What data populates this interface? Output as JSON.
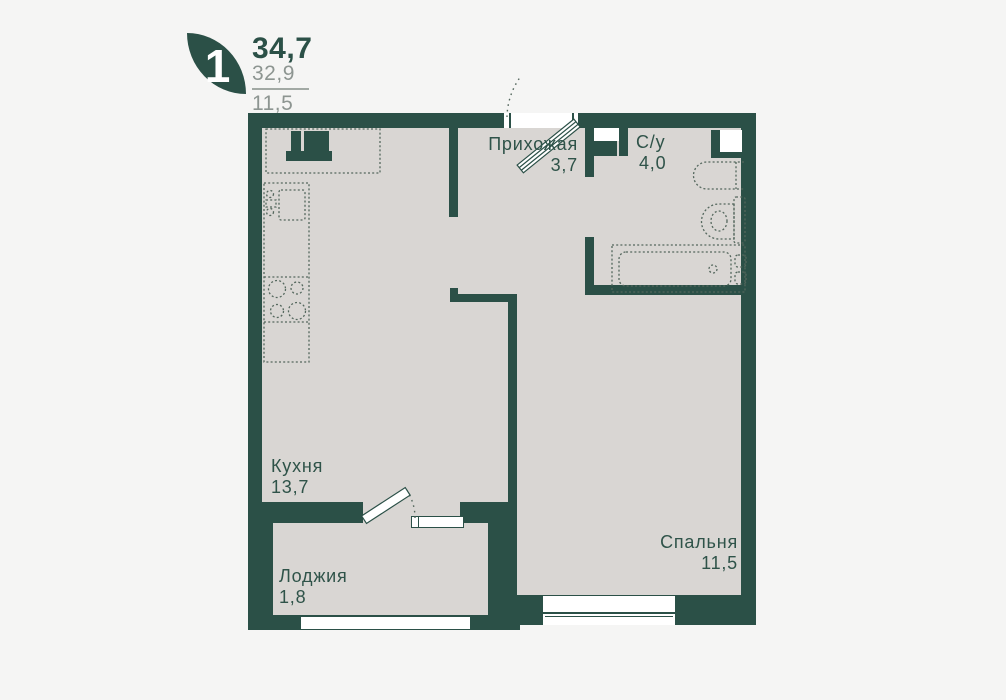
{
  "legend": {
    "rooms_count": "1",
    "total_area": "34,7",
    "living_area": "32,9",
    "kitchen_area": "11,5"
  },
  "rooms": {
    "hallway": {
      "name": "Прихожая",
      "area": "3,7"
    },
    "bathroom": {
      "name": "С/у",
      "area": "4,0"
    },
    "kitchen": {
      "name": "Кухня",
      "area": "13,7"
    },
    "bedroom": {
      "name": "Спальня",
      "area": "11,5"
    },
    "loggia": {
      "name": "Лоджия",
      "area": "1,8"
    }
  },
  "colors": {
    "wall": "#2b5047",
    "floor": "#d9d6d3",
    "background": "#f5f5f4",
    "muted_text": "#8d9591",
    "fixture_stroke": "#54675d"
  }
}
